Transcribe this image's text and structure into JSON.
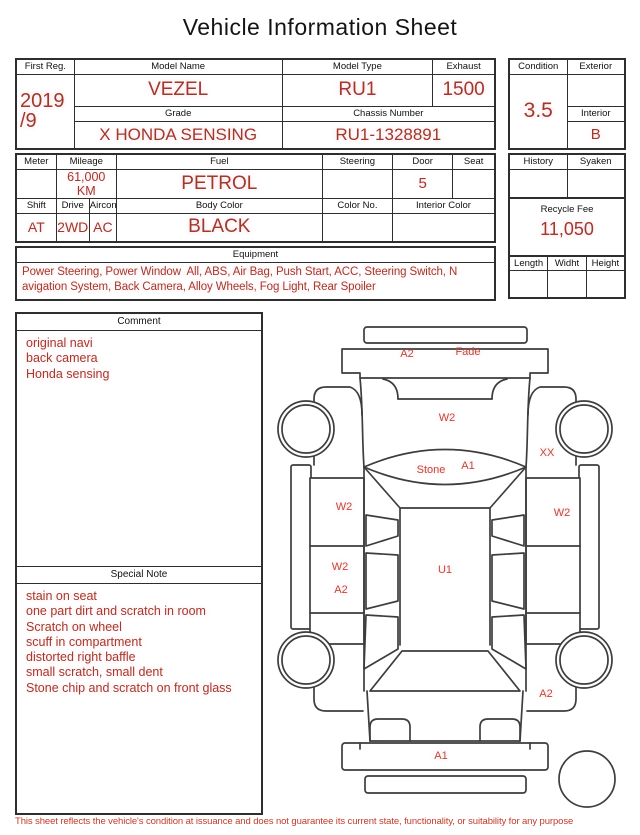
{
  "title": "Vehicle Information Sheet",
  "registration": {
    "first_reg_label": "First Reg.",
    "first_reg_value_line1": "2019",
    "first_reg_value_line2": "/9",
    "model_name_label": "Model Name",
    "model_name": "VEZEL",
    "model_type_label": "Model Type",
    "model_type": "RU1",
    "exhaust_label": "Exhaust",
    "exhaust": "1500",
    "grade_label": "Grade",
    "grade": "X HONDA SENSING",
    "chassis_number_label": "Chassis Number",
    "chassis_number": "RU1-1328891"
  },
  "condition": {
    "condition_label": "Condition",
    "condition_score": "3.5",
    "exterior_label": "Exterior",
    "exterior_grade": "",
    "interior_label": "Interior",
    "interior_grade": "B"
  },
  "specs": {
    "meter_label": "Meter",
    "meter": "",
    "mileage_label": "Mileage",
    "mileage": "61,000 KM",
    "fuel_label": "Fuel",
    "fuel": "PETROL",
    "steering_label": "Steering",
    "steering": "",
    "door_label": "Door",
    "door": "5",
    "seat_label": "Seat",
    "seat": "",
    "shift_label": "Shift",
    "shift": "AT",
    "drive_label": "Drive",
    "drive": "2WD",
    "aircon_label": "Aircon",
    "aircon": "AC",
    "body_color_label": "Body Color",
    "body_color": "BLACK",
    "color_no_label": "Color No.",
    "color_no": "",
    "interior_color_label": "Interior Color",
    "interior_color": ""
  },
  "history_panel": {
    "history_label": "History",
    "history": "",
    "syaken_label": "Syaken",
    "syaken": "",
    "recycle_fee_label": "Recycle Fee",
    "recycle_fee": "11,050",
    "length_label": "Length",
    "length": "",
    "width_label": "Widht",
    "width": "",
    "height_label": "Height",
    "height": ""
  },
  "equipment": {
    "label": "Equipment",
    "line1": "Power Steering, Power Window  All, ABS, Air Bag, Push Start, ACC, Steering Switch, N",
    "line2": "avigation System, Back Camera, Alloy Wheels, Fog Light, Rear Spoiler"
  },
  "comment": {
    "label": "Comment",
    "lines": [
      "original navi",
      "back camera",
      "Honda sensing"
    ]
  },
  "special_note": {
    "label": "Special Note",
    "lines": [
      "stain on seat",
      "one part dirt and scratch in room",
      "Scratch on wheel",
      "scuff in compartment",
      "distorted right baffle",
      "small scratch, small dent",
      "Stone chip and scratch on front glass"
    ]
  },
  "diagram": {
    "labels": [
      {
        "text": "A2",
        "area": "front-bumper"
      },
      {
        "text": "Fade",
        "area": "front-bumper"
      },
      {
        "text": "W2",
        "area": "hood"
      },
      {
        "text": "Stone",
        "area": "windshield"
      },
      {
        "text": "A1",
        "area": "windshield"
      },
      {
        "text": "XX",
        "area": "right-front-fender"
      },
      {
        "text": "W2",
        "area": "left-front-door"
      },
      {
        "text": "W2",
        "area": "right-front-door"
      },
      {
        "text": "W2",
        "area": "left-rear-door"
      },
      {
        "text": "A2",
        "area": "left-rear-door"
      },
      {
        "text": "U1",
        "area": "roof"
      },
      {
        "text": "A2",
        "area": "right-rear-quarter"
      },
      {
        "text": "A1",
        "area": "rear-bumper"
      }
    ]
  },
  "footer": {
    "disclaimer": "This sheet reflects the vehicle's condition at issuance and does not guarantee its current state, functionality, or suitability for any purpose"
  },
  "colors": {
    "value_red": "#9d3a2a",
    "diagram_label_red": "#bf4a38",
    "disclaimer_red": "#c13a2a",
    "line_black": "#2e2e2e"
  }
}
